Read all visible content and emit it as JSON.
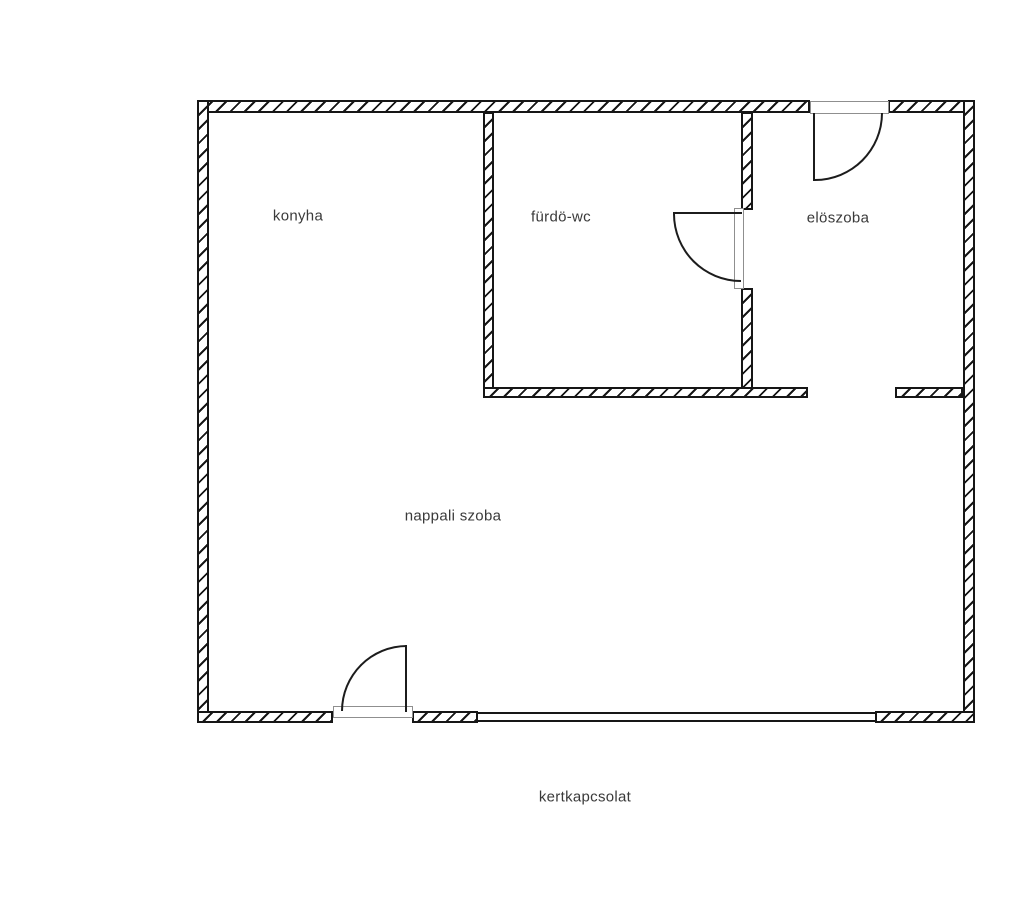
{
  "drawing": {
    "type": "floor-plan",
    "caption": "kertkapcsolat"
  },
  "rooms": [
    {
      "id": "konyha",
      "label": "konyha"
    },
    {
      "id": "furdo-wc",
      "label": "fürdö-wc"
    },
    {
      "id": "eloszoba",
      "label": "elöszoba"
    },
    {
      "id": "nappali-szoba",
      "label": "nappali szoba"
    }
  ],
  "symbols": {
    "entry_door": "door-swing-symbol",
    "bathroom_door": "door-swing-symbol",
    "terrace_door": "door-swing-symbol",
    "garden_glass": "glazed-opening-symbol"
  },
  "colors": {
    "background": "#ffffff",
    "wall_line": "#161616",
    "door_line": "#1c1c1c",
    "frame_line": "#8f8f8f",
    "text": "#3a3a3a"
  }
}
